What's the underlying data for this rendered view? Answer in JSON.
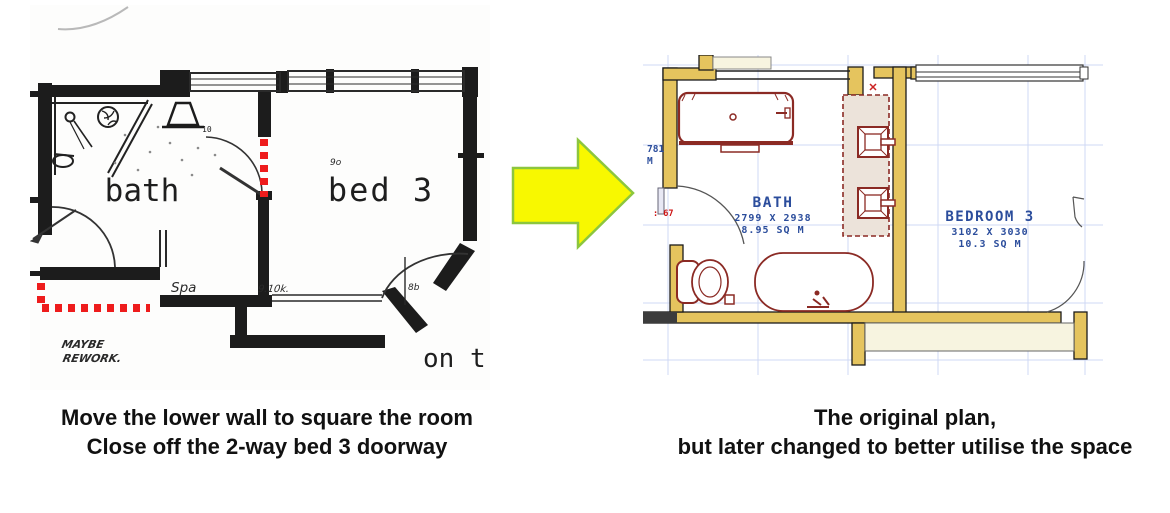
{
  "captions": {
    "left": {
      "line1": "Move the lower wall to square the room",
      "line2": "Close off the 2-way bed 3 doorway"
    },
    "right": {
      "line1": "The original plan,",
      "line2": "but later changed to better utilise the space"
    }
  },
  "left_plan": {
    "room_bath": "bath",
    "room_bed3": "bed 3",
    "label_spa": "Spa",
    "note_line1": "MAYBE",
    "note_line2": "REWORK.",
    "annotation_dim": "9.10k.",
    "annotation_8b": "8b",
    "annotation_door": "9o",
    "annotation_fixture": "10",
    "annotation_corner": "on t",
    "markup_color": "#ee1c1c"
  },
  "arrow": {
    "direction": "right",
    "fill": "#f8f800",
    "outline": "#8cc63e"
  },
  "right_plan": {
    "bath": {
      "name": "BATH",
      "dims": "2799 X 2938",
      "area": "8.95 SQ M"
    },
    "bedroom": {
      "name": "BEDROOM 3",
      "dims": "3102 X 3030",
      "area": "10.3 SQ M"
    },
    "door_dim": "781",
    "door_dim_unit": "M",
    "red_note": ": 67",
    "colors": {
      "wall": "#e5c45e",
      "fixture": "#8b2a24",
      "text": "#2b4d9c",
      "grid": "#cfd8f4"
    }
  }
}
